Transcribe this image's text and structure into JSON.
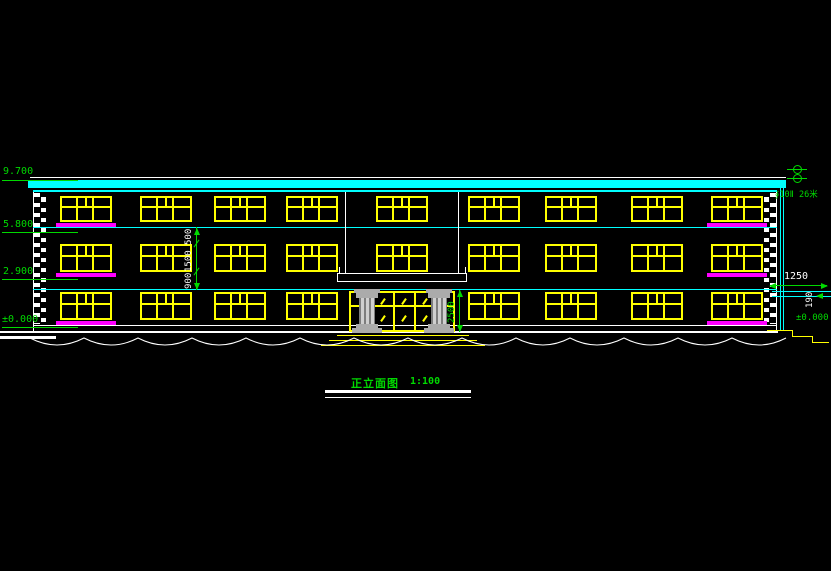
{
  "drawing": {
    "type": "cad-front-elevation",
    "title": {
      "text": "正立面图",
      "scale": "1:100"
    },
    "levels_left": [
      {
        "value": "9.700"
      },
      {
        "value": "5.800"
      },
      {
        "value": "2.900"
      },
      {
        "value": "±0.000"
      }
    ],
    "dimensions": {
      "window_chain": [
        "500",
        "1500",
        "900"
      ],
      "entrance_height": "2500",
      "right_offset": "1250",
      "right_thickness": "190"
    },
    "annotations": {
      "rain_pipe_note": "∮10Ⅱ 26米",
      "right_ground_level": "±0.000"
    },
    "colors": {
      "background": "#000000",
      "outline": "#FFFFFF",
      "window": "#FFFF00",
      "sill": "#FF00FF",
      "band": "#00FFFF",
      "annotation": "#00D900",
      "dimtext": "#FFFFFF",
      "column": "#ABABAB"
    },
    "elevation": {
      "window_columns_x": [
        60,
        140,
        214,
        286,
        376,
        468,
        545,
        631,
        711
      ],
      "window_width": 52,
      "rows": [
        {
          "y": 196,
          "h": 26
        },
        {
          "y": 244,
          "h": 28
        },
        {
          "y": 292,
          "h": 28,
          "skip": [
            4
          ]
        }
      ],
      "sill_columns": [
        0,
        8
      ],
      "door": {
        "x": 349,
        "y": 291,
        "w": 106,
        "h": 41,
        "verticals": [
          21,
          42,
          63,
          84
        ],
        "transom_y": 12
      },
      "steps": [
        [
          337,
          335,
          132
        ],
        [
          329,
          340,
          148
        ],
        [
          321,
          345,
          164
        ]
      ],
      "scallop": {
        "x": 30,
        "y": 337,
        "w": 758,
        "h": 16,
        "arc": 54
      }
    }
  }
}
